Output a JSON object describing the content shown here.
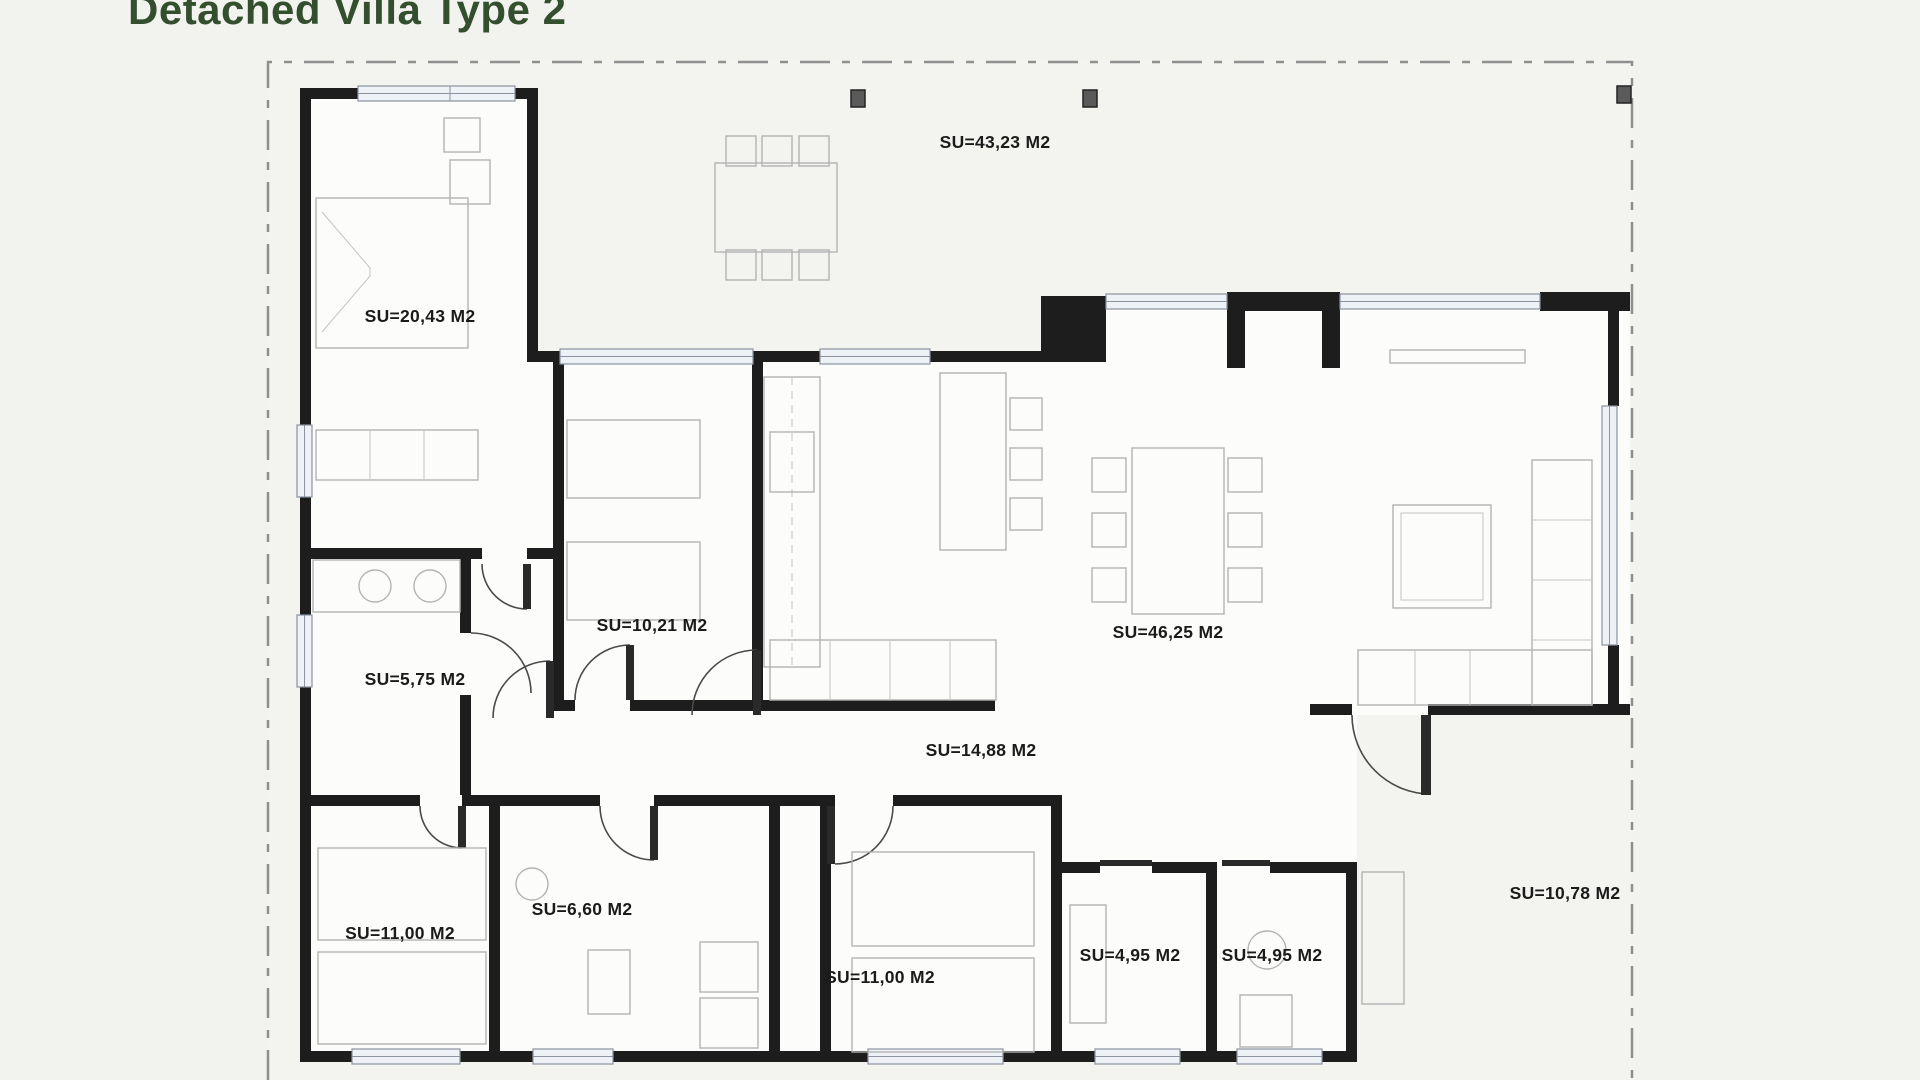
{
  "title": {
    "text": "Detached Villa Type 2",
    "color": "#344f2e"
  },
  "plan": {
    "area_unit": "M2",
    "wall_color": "#1d1d1d",
    "boundary_style": "dashed",
    "rooms": [
      {
        "id": "terrace",
        "label": "SU=43,23 M2"
      },
      {
        "id": "master-bedroom",
        "label": "SU=20,43 M2"
      },
      {
        "id": "bedroom-middle",
        "label": "SU=10,21 M2"
      },
      {
        "id": "utility-room",
        "label": "SU=5,75 M2"
      },
      {
        "id": "living-dining",
        "label": "SU=46,25 M2"
      },
      {
        "id": "hallway",
        "label": "SU=14,88 M2"
      },
      {
        "id": "bedroom-left",
        "label": "SU=11,00 M2"
      },
      {
        "id": "bathroom",
        "label": "SU=6,60 M2"
      },
      {
        "id": "bedroom-right",
        "label": "SU=11,00 M2"
      },
      {
        "id": "wc-1",
        "label": "SU=4,95 M2"
      },
      {
        "id": "wc-2",
        "label": "SU=4,95 M2"
      },
      {
        "id": "entrance-porch",
        "label": "SU=10,78 M2"
      }
    ]
  }
}
